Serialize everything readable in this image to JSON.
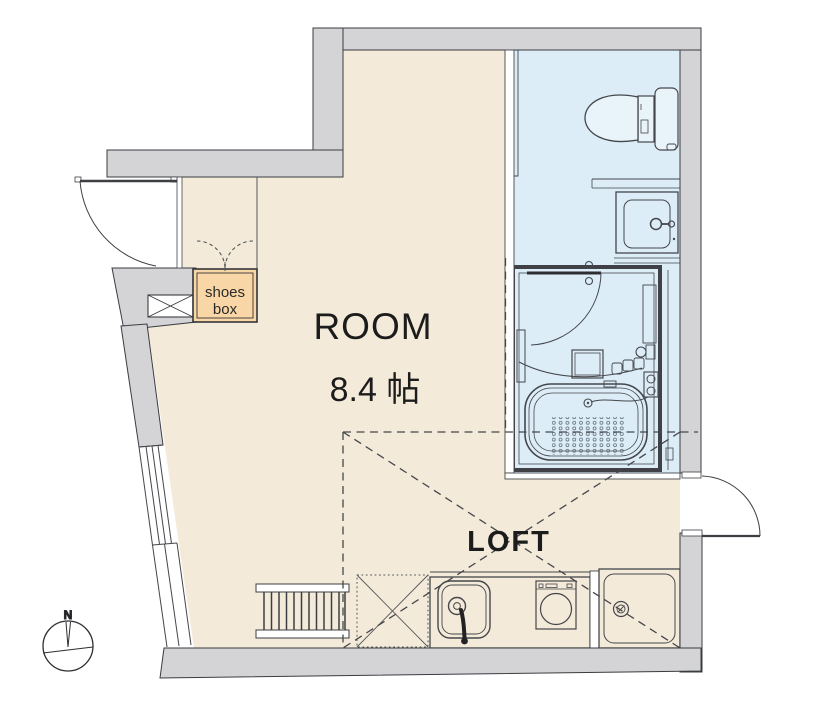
{
  "meta": {
    "drawing_type": "apartment floor plan"
  },
  "labels": {
    "room_name": "ROOM",
    "room_area": "8.4 帖",
    "loft": "LOFT",
    "shoes_box_line1": "shoes",
    "shoes_box_line2": "box",
    "compass_north": "N"
  },
  "rooms": [
    {
      "name": "ROOM",
      "area": "8.4 帖"
    },
    {
      "name": "LOFT",
      "type": "loft-area-dashed"
    },
    {
      "name": "bathroom",
      "fixtures": [
        "toilet",
        "vanity-sink",
        "unit-bath",
        "bathtub"
      ]
    }
  ],
  "fixtures": [
    "toilet",
    "vanity-sink",
    "unit-bath",
    "bathtub",
    "shower-mixer",
    "kitchen-sink",
    "single-burner-stove",
    "washing-machine-pan",
    "loft-ladder",
    "shoes-box",
    "pipe-space",
    "refrigerator-space",
    "compass"
  ],
  "colors": {
    "wall": "#d4d4d6",
    "room_floor": "#f4ead9",
    "bathroom_floor": "#dcedf8",
    "shoes_box": "#f9d6a6",
    "line": "#45474b"
  }
}
